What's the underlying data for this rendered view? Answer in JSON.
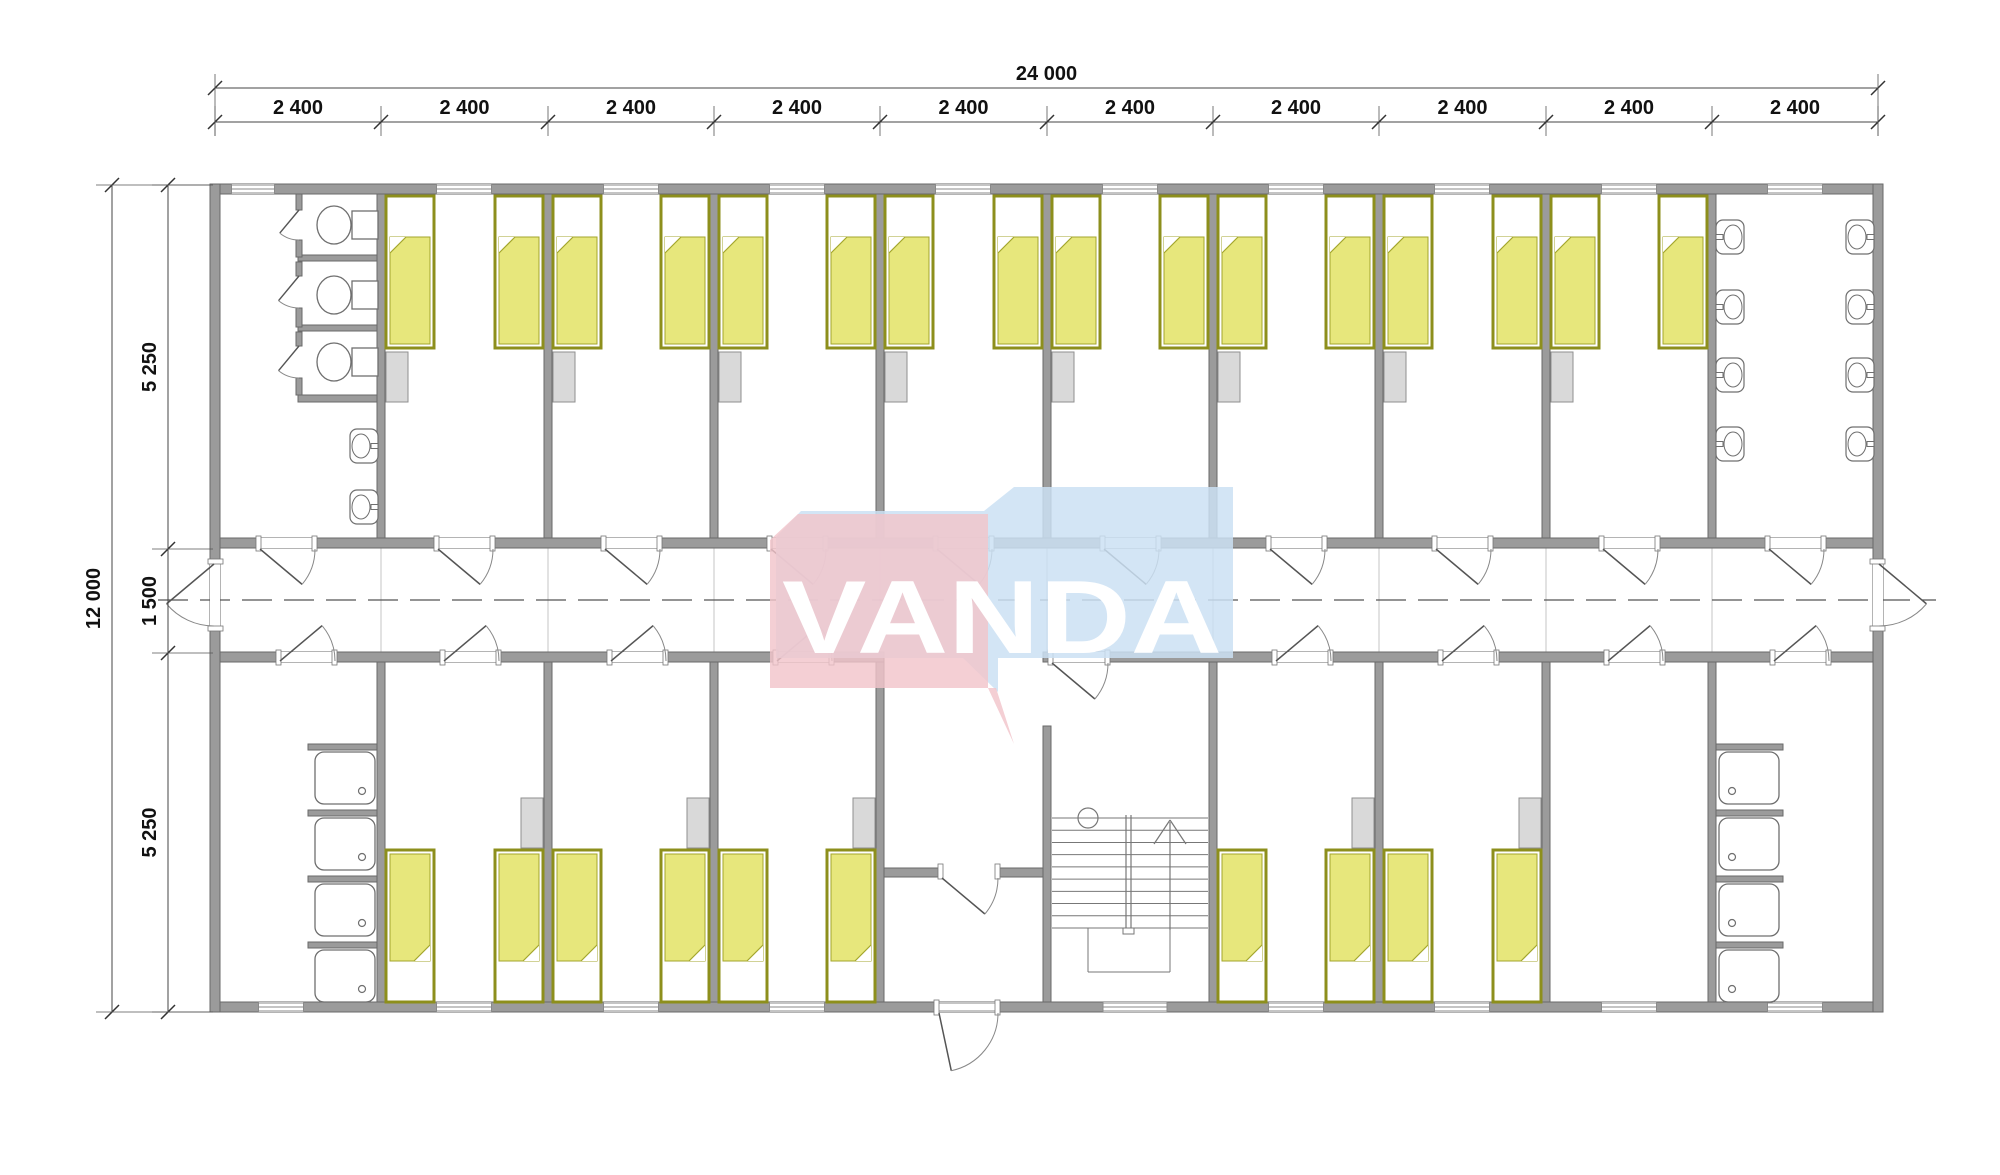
{
  "drawing": {
    "brand_name": "VANDA",
    "dim_total_width": "24 000",
    "dim_module": "2 400",
    "dim_total_height": "12 000",
    "dim_top_band": "5 250",
    "dim_corridor": "1 500",
    "dim_bottom_band": "5 250"
  },
  "colors": {
    "wall_fill": "#9b9b9b",
    "wall_stroke": "#6a6a6a",
    "bed_frame": "#8d8f1c",
    "bed_blanket": "#e7e77c",
    "bed_blanket_stroke": "#a3a52c",
    "wardrobe_fill": "#d9d9d9",
    "wardrobe_stroke": "#8f8f8f",
    "fixture_stroke": "#6f6f6f",
    "dim_color": "#111111",
    "logo_pink": "#f2c4cb",
    "logo_blue": "#cbe1f3",
    "logo_text": "#ffffff",
    "centerline": "#555555",
    "grid_line": "#c4c4c4"
  },
  "geometry": {
    "canvas": [
      2000,
      1175
    ],
    "plan": {
      "x1": 215,
      "x2": 1878,
      "y1": 185,
      "y2": 1012
    },
    "boundaries": [
      215,
      381,
      548,
      714,
      880,
      1047,
      1213,
      1379,
      1546,
      1712,
      1878
    ],
    "walls_h": [
      [
        210,
        184,
        1673,
        10
      ],
      [
        210,
        1002,
        1673,
        10
      ],
      [
        215,
        538,
        1663,
        10
      ],
      [
        215,
        652,
        669,
        10
      ],
      [
        1043,
        652,
        835,
        10
      ],
      [
        884,
        868,
        159,
        9
      ],
      [
        298,
        255,
        87,
        6
      ],
      [
        298,
        325,
        87,
        6
      ],
      [
        298,
        395,
        87,
        7
      ],
      [
        308,
        744,
        73,
        6
      ],
      [
        308,
        810,
        73,
        6
      ],
      [
        308,
        876,
        73,
        6
      ],
      [
        308,
        942,
        73,
        6
      ],
      [
        1712,
        744,
        71,
        6
      ],
      [
        1712,
        810,
        71,
        6
      ],
      [
        1712,
        876,
        71,
        6
      ],
      [
        1712,
        942,
        71,
        6
      ]
    ],
    "walls_v": [
      [
        210,
        184,
        10,
        828
      ],
      [
        1873,
        184,
        10,
        828
      ],
      [
        377,
        194,
        8,
        344
      ],
      [
        544,
        194,
        8,
        344
      ],
      [
        710,
        194,
        8,
        344
      ],
      [
        876,
        194,
        8,
        344
      ],
      [
        1043,
        194,
        8,
        344
      ],
      [
        1209,
        194,
        8,
        344
      ],
      [
        1375,
        194,
        8,
        344
      ],
      [
        1542,
        194,
        8,
        344
      ],
      [
        1708,
        194,
        8,
        344
      ],
      [
        377,
        662,
        8,
        340
      ],
      [
        544,
        662,
        8,
        340
      ],
      [
        710,
        662,
        8,
        340
      ],
      [
        876,
        662,
        8,
        340
      ],
      [
        1209,
        662,
        8,
        340
      ],
      [
        1375,
        662,
        8,
        340
      ],
      [
        1542,
        662,
        8,
        340
      ],
      [
        1708,
        662,
        8,
        340
      ],
      [
        1043,
        726,
        8,
        276
      ],
      [
        296,
        194,
        6,
        16
      ],
      [
        296,
        240,
        6,
        17
      ],
      [
        296,
        262,
        6,
        14
      ],
      [
        296,
        308,
        6,
        19
      ],
      [
        296,
        332,
        6,
        14
      ],
      [
        296,
        378,
        6,
        17
      ]
    ],
    "windows_top": [
      [
        253,
        43
      ],
      [
        464,
        55
      ],
      [
        631,
        55
      ],
      [
        797,
        55
      ],
      [
        963,
        55
      ],
      [
        1130,
        55
      ],
      [
        1296,
        55
      ],
      [
        1462,
        55
      ],
      [
        1629,
        55
      ],
      [
        1795,
        55
      ]
    ],
    "windows_bottom": [
      [
        281,
        45
      ],
      [
        464,
        55
      ],
      [
        631,
        55
      ],
      [
        797,
        55
      ],
      [
        1135,
        64
      ],
      [
        1296,
        55
      ],
      [
        1462,
        55
      ],
      [
        1629,
        55
      ],
      [
        1795,
        55
      ]
    ],
    "doors_corr_top": [
      [
        258,
        57
      ],
      [
        436,
        57
      ],
      [
        603,
        57
      ],
      [
        769,
        57
      ],
      [
        935,
        57
      ],
      [
        1102,
        57
      ],
      [
        1268,
        57
      ],
      [
        1434,
        57
      ],
      [
        1601,
        57
      ],
      [
        1767,
        57
      ]
    ],
    "doors_corr_bottom": [
      [
        278,
        57
      ],
      [
        442,
        57
      ],
      [
        609,
        57
      ],
      [
        775,
        57
      ],
      [
        1274,
        57
      ],
      [
        1440,
        57
      ],
      [
        1606,
        57
      ],
      [
        1772,
        57
      ]
    ],
    "door_stair": [
      1050,
      58
    ],
    "door_vestibule": [
      940,
      58
    ],
    "door_entry": [
      936,
      62
    ],
    "exit_gap_y": [
      562,
      66
    ],
    "beds": {
      "top_x": [
        386,
        495,
        553,
        661,
        719,
        827,
        885,
        994,
        1052,
        1160,
        1218,
        1326,
        1384,
        1493,
        1551,
        1659
      ],
      "top_y": 196,
      "bottom_x": [
        386,
        495,
        553,
        661,
        719,
        827,
        1218,
        1326,
        1384,
        1493
      ],
      "bottom_y": 850,
      "w": 48,
      "h": 152
    },
    "wardrobes": {
      "top_x": [
        386,
        553,
        719,
        885,
        1052,
        1218,
        1384,
        1551
      ],
      "top_y": 352,
      "bottom_x": [
        521,
        687,
        853,
        1352,
        1519
      ],
      "bottom_y": 798,
      "w": 22,
      "h": 50
    },
    "toilets_cy": [
      225,
      295,
      362
    ],
    "stall_door_gaps": [
      [
        210,
        240
      ],
      [
        276,
        308
      ],
      [
        346,
        378
      ]
    ],
    "sinks_toilet_room": {
      "wall_x": 378,
      "cys": [
        446,
        507
      ],
      "facing": "left"
    },
    "sinks_washroom_left": {
      "wall_x": 1716,
      "cys": [
        237,
        307,
        375,
        444
      ],
      "facing": "right"
    },
    "sinks_washroom_right": {
      "wall_x": 1874,
      "cys": [
        237,
        307,
        375,
        444
      ],
      "facing": "left"
    },
    "showers": {
      "left_x": 315,
      "right_x": 1719,
      "ys": [
        752,
        818,
        884,
        950
      ],
      "w": 60,
      "h": 52
    },
    "stairs": {
      "x1": 1052,
      "x2": 1208,
      "tread_y1": 818,
      "tread_y2": 928,
      "treads": 10,
      "rail_x": 1126,
      "circle": [
        1088,
        818,
        10
      ],
      "arrow_x": 1170,
      "landing_y": 972,
      "well_x1": 1088,
      "well_x2": 1170
    },
    "corridor": {
      "y1": 548,
      "y2": 652,
      "centerline_y": 600,
      "centerline_x1": 158,
      "centerline_x2": 1936
    },
    "dims": {
      "line_total_y": 88,
      "line_module_y": 122,
      "line_height_x": 112,
      "line_bands_x": 168,
      "band_ticks_y": [
        185,
        549,
        653,
        1012
      ]
    },
    "logo": {
      "blue_points": "776,537 801,511 984,511 1014,487 1233,487 1233,658 998,658 998,692 963,658 776,658",
      "pink_points": "770,540 798,514 988,514 988,688 1014,744 996,688 770,688",
      "text_x": 1002,
      "text_y": 653,
      "font_size": 104,
      "text_length": 440
    }
  }
}
